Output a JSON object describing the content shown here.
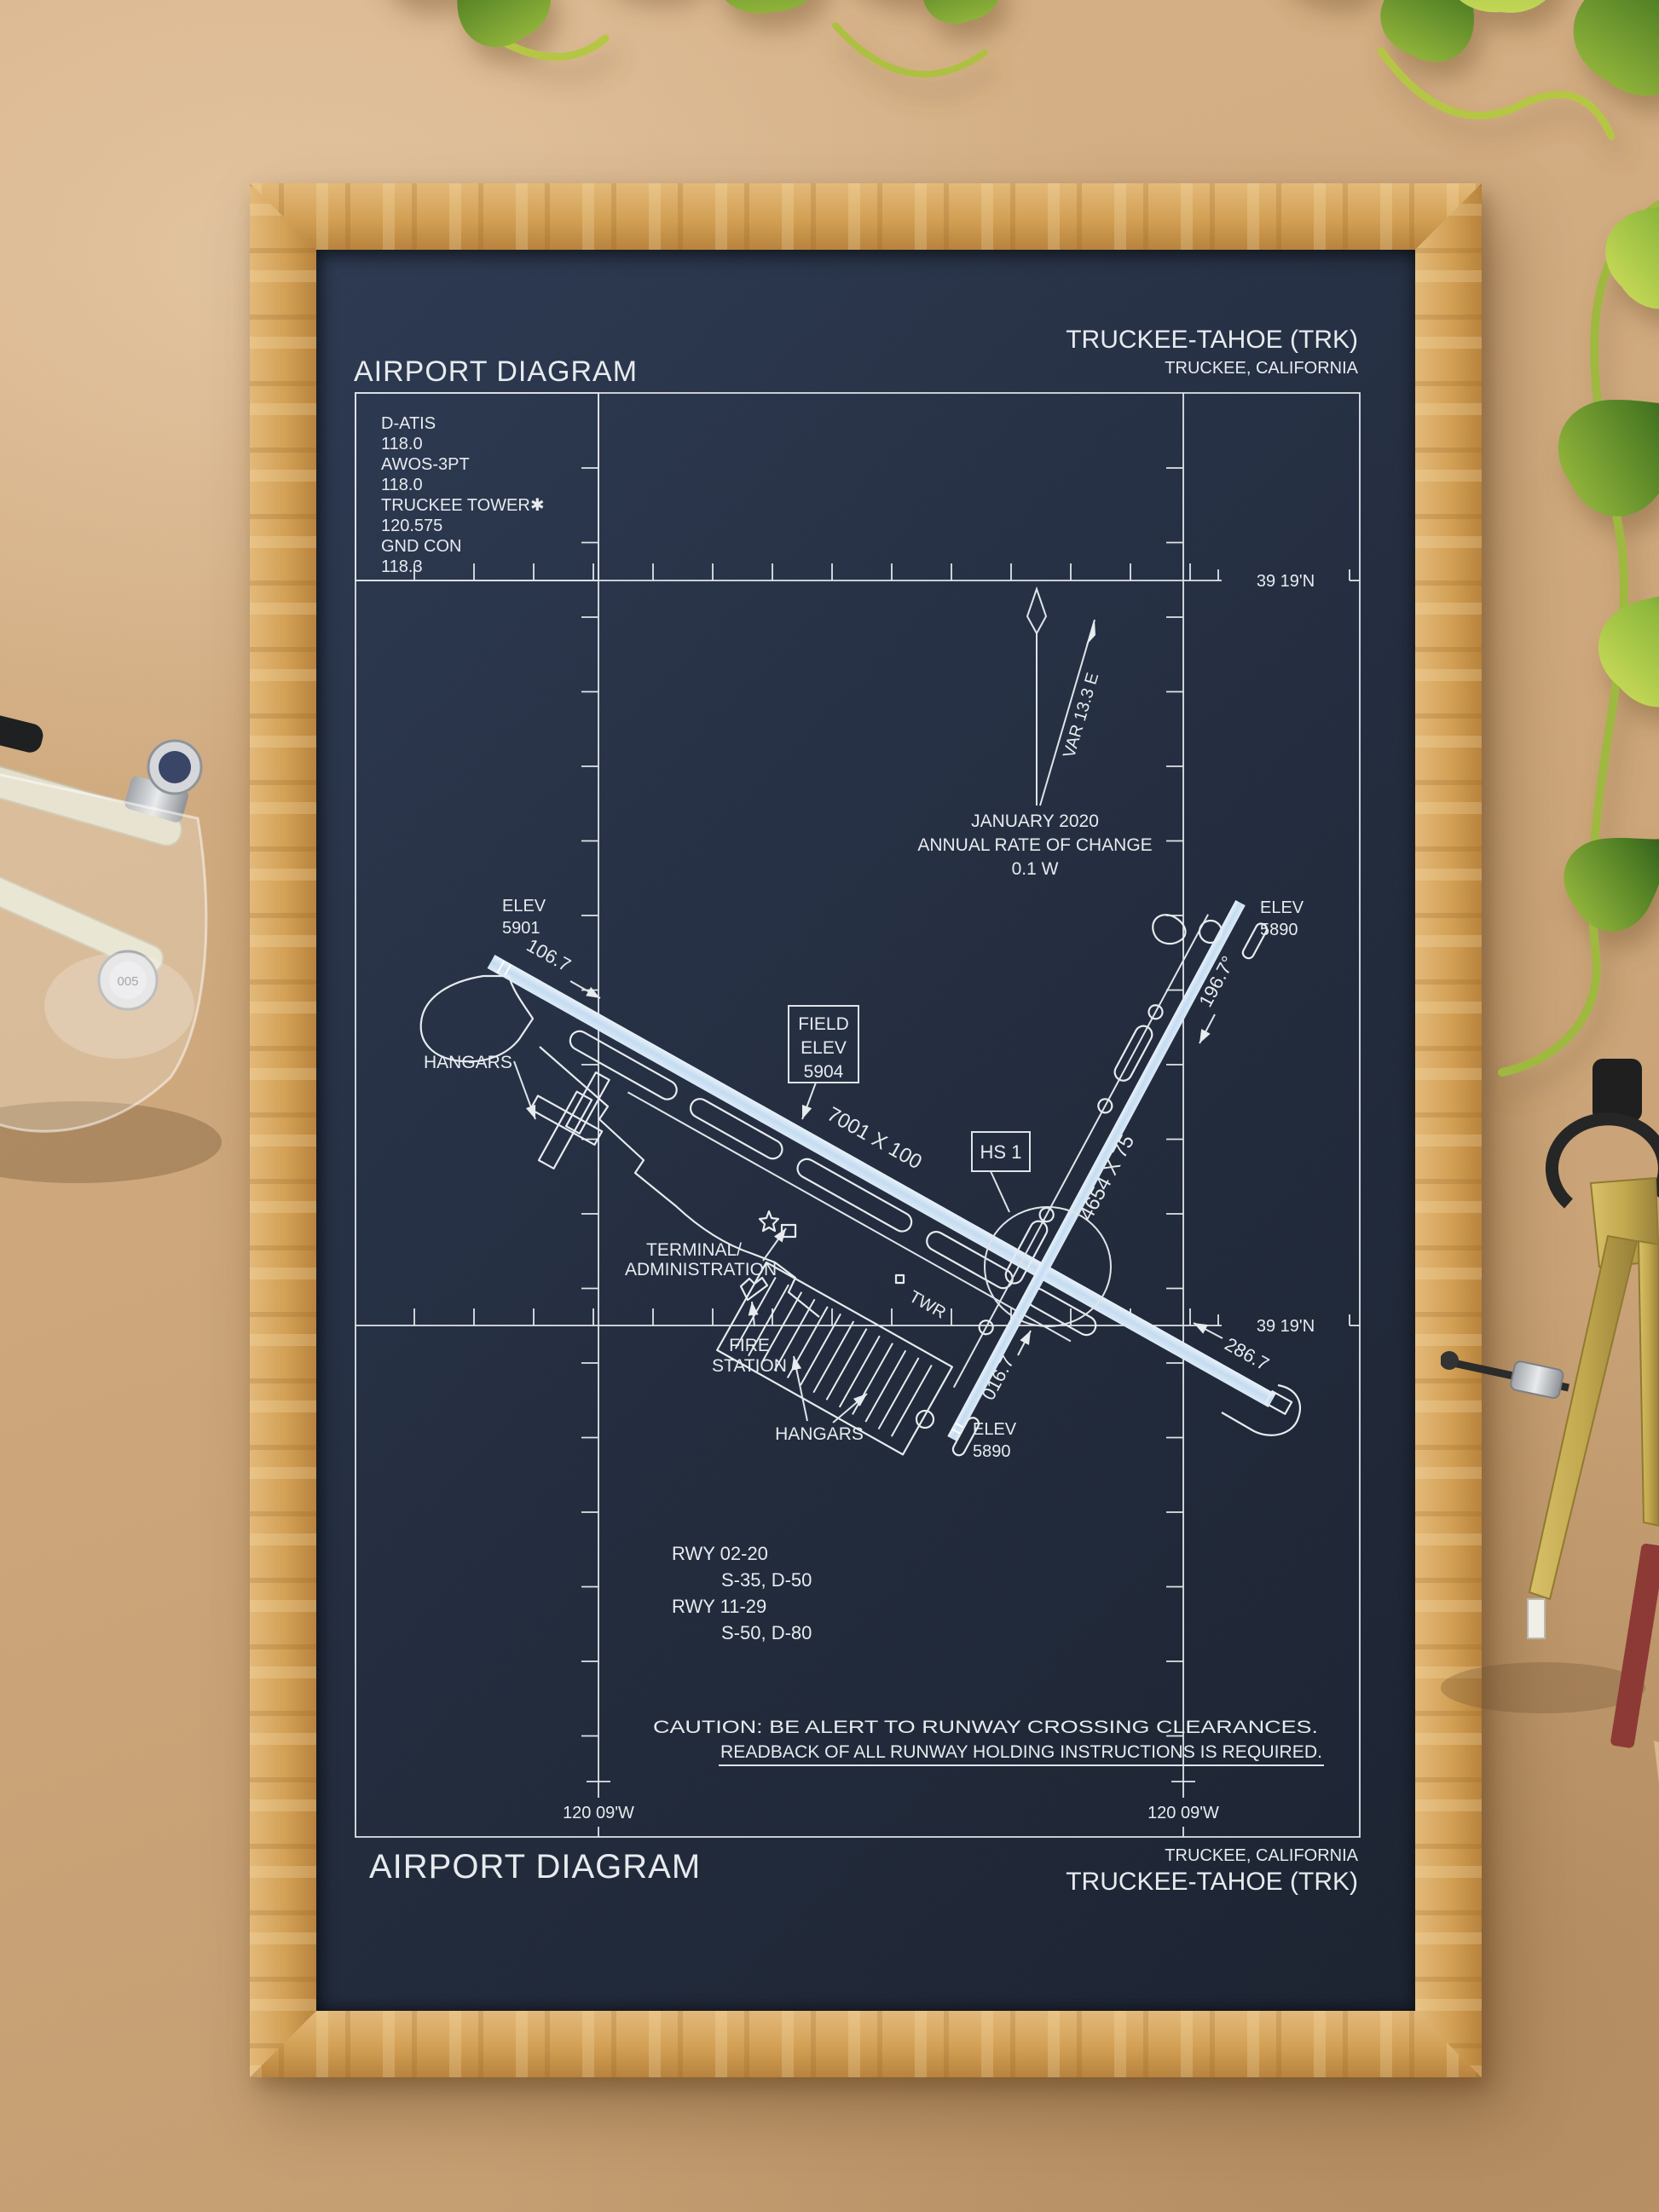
{
  "poster": {
    "header": {
      "title": "AIRPORT DIAGRAM",
      "airport": "TRUCKEE-TAHOE (TRK)",
      "city": "TRUCKEE, CALIFORNIA"
    },
    "footer": {
      "title": "AIRPORT DIAGRAM",
      "city": "TRUCKEE, CALIFORNIA",
      "airport": "TRUCKEE-TAHOE (TRK)"
    },
    "comm": {
      "lines": [
        "D-ATIS",
        "118.0",
        "AWOS-3PT",
        "118.0",
        "TRUCKEE TOWER✱",
        "120.575",
        "GND CON",
        "118.3"
      ]
    },
    "variation": {
      "var_label": "VAR 13.3 E",
      "date": "JANUARY 2020",
      "rate_label": "ANNUAL RATE OF CHANGE",
      "rate_value": "0.1 W"
    },
    "coords": {
      "lat": "39 19'N",
      "lon": "120 09'W"
    },
    "field_elev": {
      "l1": "FIELD",
      "l2": "ELEV",
      "l3": "5904"
    },
    "hot_spot": "HS 1",
    "rwy1129": {
      "dim": "7001 X 100",
      "hdg_w": "106.7",
      "hdg_e": "286.7",
      "elev_w1": "ELEV",
      "elev_w2": "5901"
    },
    "rwy0220": {
      "dim": "4654 X 75",
      "hdg_n": "196.7°",
      "hdg_s": "016.7",
      "elev_n1": "ELEV",
      "elev_n2": "5890",
      "elev_s1": "ELEV",
      "elev_s2": "5890"
    },
    "labels": {
      "hangars_w": "HANGARS",
      "hangars_s": "HANGARS",
      "terminal1": "TERMINAL/",
      "terminal2": "ADMINISTRATION",
      "fire1": "FIRE",
      "fire2": "STATION",
      "twr": "TWR"
    },
    "runway_data": {
      "r1": "RWY 02-20",
      "c1": "S-35, D-50",
      "r2": "RWY 11-29",
      "c2": "S-50, D-80"
    },
    "caution": {
      "l1": "CAUTION: BE ALERT TO RUNWAY CROSSING CLEARANCES.",
      "l2": "READBACK OF ALL RUNWAY HOLDING INSTRUCTIONS IS REQUIRED."
    }
  },
  "colors": {
    "paper": "#212a3c",
    "ink": "#e7ebee",
    "runway_fill": "#cfe2f2",
    "frame_wood": "#d2a055",
    "background": "#cfa87c",
    "leaf_green": "#8db83c",
    "brass": "#c2a84e"
  },
  "scene": {
    "pen_cap_label": "005"
  }
}
